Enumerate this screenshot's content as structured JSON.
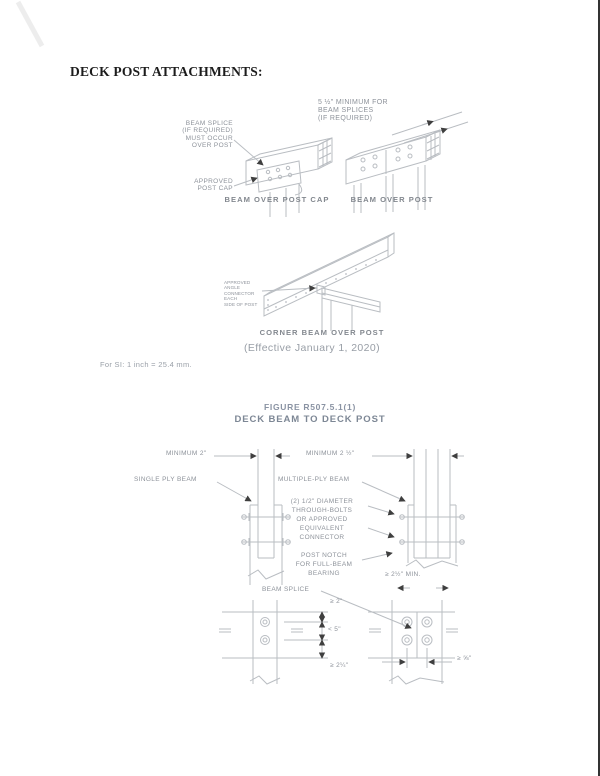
{
  "page": {
    "title": "DECK POST ATTACHMENTS:",
    "si_note": "For SI: 1 inch = 25.4 mm."
  },
  "figure_top": {
    "beam_over_post_cap": {
      "splice_label": "BEAM SPLICE\n(IF REQUIRED)\nMUST OCCUR\nOVER POST",
      "post_cap_label": "APPROVED\nPOST CAP",
      "caption": "BEAM OVER POST CAP"
    },
    "beam_over_post": {
      "min_splice_label": "5 ½\" MINIMUM FOR\nBEAM SPLICES\n(IF REQUIRED)",
      "caption": "BEAM OVER POST"
    },
    "corner_beam": {
      "connector_label": "APPROVED ANGLE\nCONNECTOR EACH\nSIDE OF POST",
      "caption": "CORNER BEAM OVER POST",
      "effective_note": "(Effective January 1, 2020)"
    }
  },
  "figure_bottom": {
    "figure_number": "FIGURE R507.5.1(1)",
    "figure_title": "DECK BEAM TO DECK POST",
    "labels": {
      "minimum_2": "MINIMUM 2\"",
      "minimum_2_half": "MINIMUM 2 ½\"",
      "single_ply": "SINGLE PLY BEAM",
      "multiple_ply": "MULTIPLE-PLY BEAM",
      "through_bolts": "(2) 1/2\" DIAMETER\nTHROUGH-BOLTS\nOR APPROVED\nEQUIVALENT\nCONNECTOR",
      "post_notch": "POST NOTCH\nFOR FULL-BEAM\nBEARING",
      "min_bearing": "≥ 2½\" MIN.",
      "beam_splice": "BEAM SPLICE",
      "dim_top": "≥ 2\"",
      "dim_mid": "< 5\"",
      "dim_bottom": "≥ 2¼\"",
      "dim_edge": "≥ ⅝\""
    }
  },
  "colors": {
    "line_gray": "#b9bdc2",
    "label_gray": "#8d929a",
    "arrow_dark": "#3f3f3f",
    "title_black": "#1c1c1c",
    "figure_title_gray": "#7d8795"
  }
}
